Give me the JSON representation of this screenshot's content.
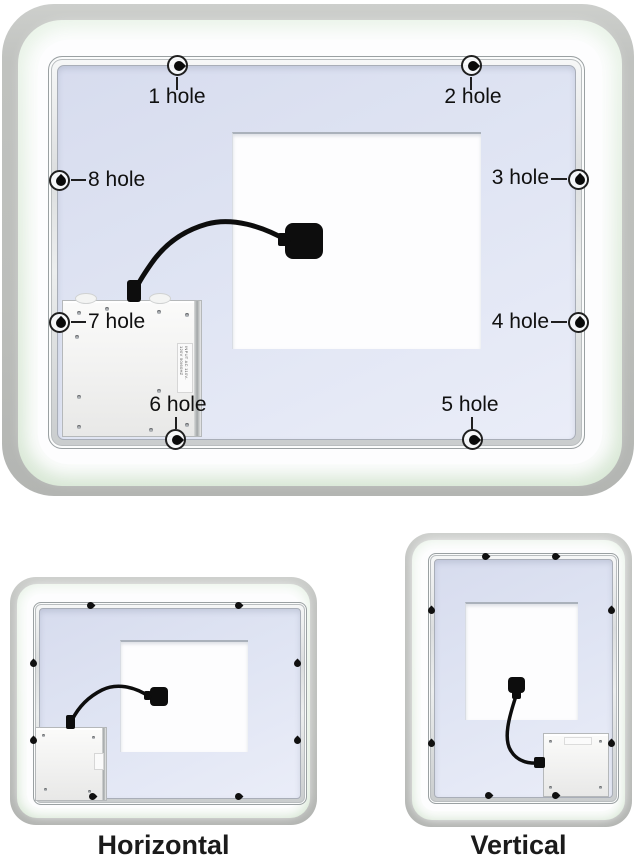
{
  "main_view": {
    "holes": [
      {
        "label": "1 hole"
      },
      {
        "label": "2 hole"
      },
      {
        "label": "3 hole"
      },
      {
        "label": "4 hole"
      },
      {
        "label": "5 hole"
      },
      {
        "label": "6 hole"
      },
      {
        "label": "7 hole"
      },
      {
        "label": "8 hole"
      }
    ],
    "driver_box": {
      "sticker_text": "INPUT AC 110V-120V 50/60HZ"
    }
  },
  "thumbnails": [
    {
      "caption": "Horizontal"
    },
    {
      "caption": "Vertical"
    }
  ],
  "colors": {
    "background_gray": "#bcbebb",
    "mint_glow": "#e0eddd",
    "panel_lavender": "#dfe4f3",
    "frame_silver": "#eceeee",
    "cable_black": "#0d0d0d"
  }
}
